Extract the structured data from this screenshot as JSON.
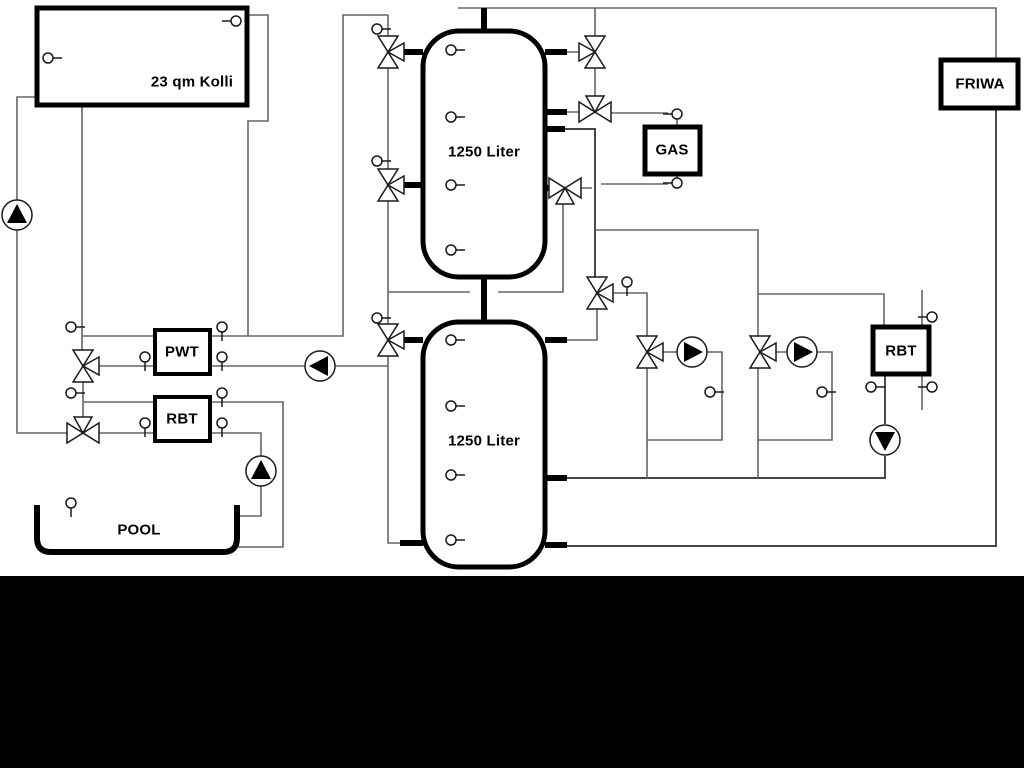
{
  "diagram": {
    "labels": {
      "collector": "23 qm Kolli",
      "tank_top": "1250 Liter",
      "tank_bottom": "1250 Liter",
      "pwt": "PWT",
      "rbt_left": "RBT",
      "gas": "GAS",
      "friwa": "FRIWA",
      "rbt_right": "RBT",
      "pool": "POOL"
    },
    "colors": {
      "pipe": "#666666",
      "component_stroke": "#1a1a1a",
      "thick_pipe": "#000000",
      "background": "#ffffff",
      "bottom_mask": "#000000"
    }
  }
}
